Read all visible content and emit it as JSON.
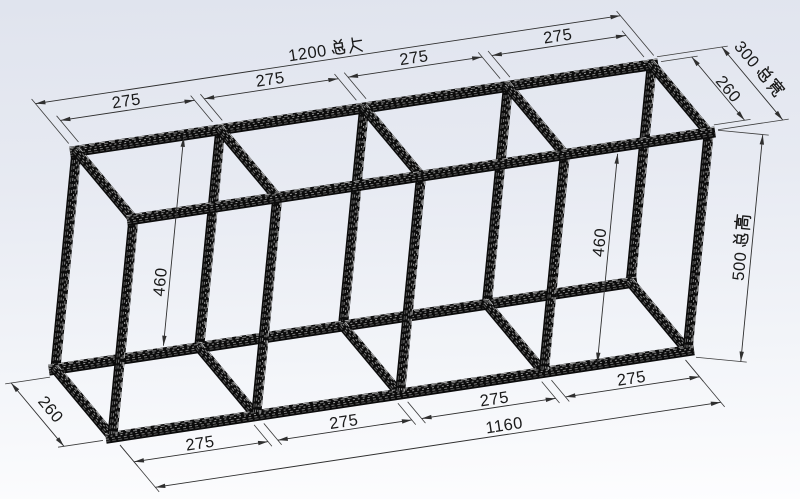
{
  "viewport": {
    "width": 800,
    "height": 499,
    "bg_top": "#e0e4ee",
    "bg_mid": "#e7eaf2",
    "bg_bottom": "#fdfdfe"
  },
  "model": {
    "length_mm": 1200,
    "width_mm": 300,
    "height_mm": 500,
    "profile_mm": 20,
    "bay_mm": 275,
    "bay_count": 4,
    "member_color": "#0b0b0b",
    "groove_colors": [
      "#6e6e6e",
      "#9a9a9a",
      "#787878",
      "#525252",
      "#b9b9b9"
    ]
  },
  "projection": {
    "origin": [
      70,
      145
    ],
    "ux": [
      0.4875,
      -0.0733
    ],
    "uy": [
      0.2033,
      0.2433
    ],
    "uz": [
      -0.044,
      0.454
    ]
  },
  "dim_style": {
    "line_color": "#2f2f2f",
    "ext_color": "#3b3b3b",
    "text_color": "#1a1a1a",
    "font_px": 16.5,
    "arrow_len": 10,
    "arrow_half_w": 2.2
  },
  "dimensions": [
    {
      "id": "total-length",
      "label": "1200 总长",
      "p1": [
        0,
        0,
        0
      ],
      "p2": [
        1200,
        0,
        0
      ],
      "kind": "axisy",
      "offset": -170,
      "t": 0.5,
      "side": -10,
      "read": "along"
    },
    {
      "id": "top-bay-1",
      "label": "275",
      "p1": [
        20,
        0,
        0
      ],
      "p2": [
        295,
        0,
        0
      ],
      "kind": "axisy",
      "offset": -95,
      "t": 0.5,
      "side": -10,
      "read": "along"
    },
    {
      "id": "top-bay-2",
      "label": "275",
      "p1": [
        315,
        0,
        0
      ],
      "p2": [
        590,
        0,
        0
      ],
      "kind": "axisy",
      "offset": -95,
      "t": 0.5,
      "side": -10,
      "read": "along"
    },
    {
      "id": "top-bay-3",
      "label": "275",
      "p1": [
        610,
        0,
        0
      ],
      "p2": [
        885,
        0,
        0
      ],
      "kind": "axisy",
      "offset": -95,
      "t": 0.5,
      "side": -10,
      "read": "along"
    },
    {
      "id": "top-bay-4",
      "label": "275",
      "p1": [
        905,
        0,
        0
      ],
      "p2": [
        1180,
        0,
        0
      ],
      "kind": "axisy",
      "offset": -95,
      "t": 0.5,
      "side": -10,
      "read": "along"
    },
    {
      "id": "top-width-inner",
      "label": "260",
      "p1": [
        1200,
        20,
        0
      ],
      "p2": [
        1200,
        280,
        0
      ],
      "kind": "axisx",
      "offset": 67,
      "t": 0.58,
      "side": -8,
      "read": "along"
    },
    {
      "id": "total-width",
      "label": "300 总宽",
      "p1": [
        1200,
        0,
        0
      ],
      "p2": [
        1200,
        300,
        0
      ],
      "kind": "axisx",
      "offset": 137,
      "t": 0.43,
      "side": -15,
      "read": "along"
    },
    {
      "id": "total-height",
      "label": "500 总高",
      "p1": [
        1200,
        300,
        0
      ],
      "p2": [
        1200,
        300,
        500
      ],
      "kind": "perp",
      "offset": -47,
      "t": 0.5,
      "side": -11,
      "read": "up"
    },
    {
      "id": "inner-height-left",
      "label": "460",
      "p1": [
        235,
        0,
        20
      ],
      "p2": [
        235,
        0,
        480
      ],
      "kind": "perp",
      "offset": 0,
      "t": 0.7,
      "side": -10,
      "read": "up"
    },
    {
      "id": "inner-height-right",
      "label": "460",
      "p1": [
        1000,
        300,
        20
      ],
      "p2": [
        1000,
        300,
        480
      ],
      "kind": "perp",
      "offset": 0,
      "t": 0.43,
      "side": -10,
      "read": "up"
    },
    {
      "id": "bottom-bay-1",
      "label": "275",
      "p1": [
        20,
        300,
        500
      ],
      "p2": [
        295,
        300,
        500
      ],
      "kind": "axisy",
      "offset": 75,
      "t": 0.5,
      "side": -9,
      "read": "along"
    },
    {
      "id": "bottom-bay-2",
      "label": "275",
      "p1": [
        315,
        300,
        500
      ],
      "p2": [
        590,
        300,
        500
      ],
      "kind": "axisy",
      "offset": 75,
      "t": 0.5,
      "side": -9,
      "read": "along"
    },
    {
      "id": "bottom-bay-3",
      "label": "275",
      "p1": [
        610,
        300,
        500
      ],
      "p2": [
        885,
        300,
        500
      ],
      "kind": "axisy",
      "offset": 75,
      "t": 0.55,
      "side": -9,
      "read": "along"
    },
    {
      "id": "bottom-bay-4",
      "label": "275",
      "p1": [
        905,
        300,
        500
      ],
      "p2": [
        1180,
        300,
        500
      ],
      "kind": "axisy",
      "offset": 75,
      "t": 0.5,
      "side": -9,
      "read": "along"
    },
    {
      "id": "bottom-inner-span",
      "label": "1160",
      "p1": [
        20,
        300,
        500
      ],
      "p2": [
        1180,
        300,
        500
      ],
      "kind": "axisy",
      "offset": 180,
      "t": 0.62,
      "side": -10,
      "read": "along"
    },
    {
      "id": "bottom-width-inner",
      "label": "260",
      "p1": [
        0,
        20,
        500
      ],
      "p2": [
        0,
        280,
        500
      ],
      "kind": "axisx",
      "offset": -84,
      "t": 0.55,
      "side": -14,
      "read": "along"
    }
  ]
}
